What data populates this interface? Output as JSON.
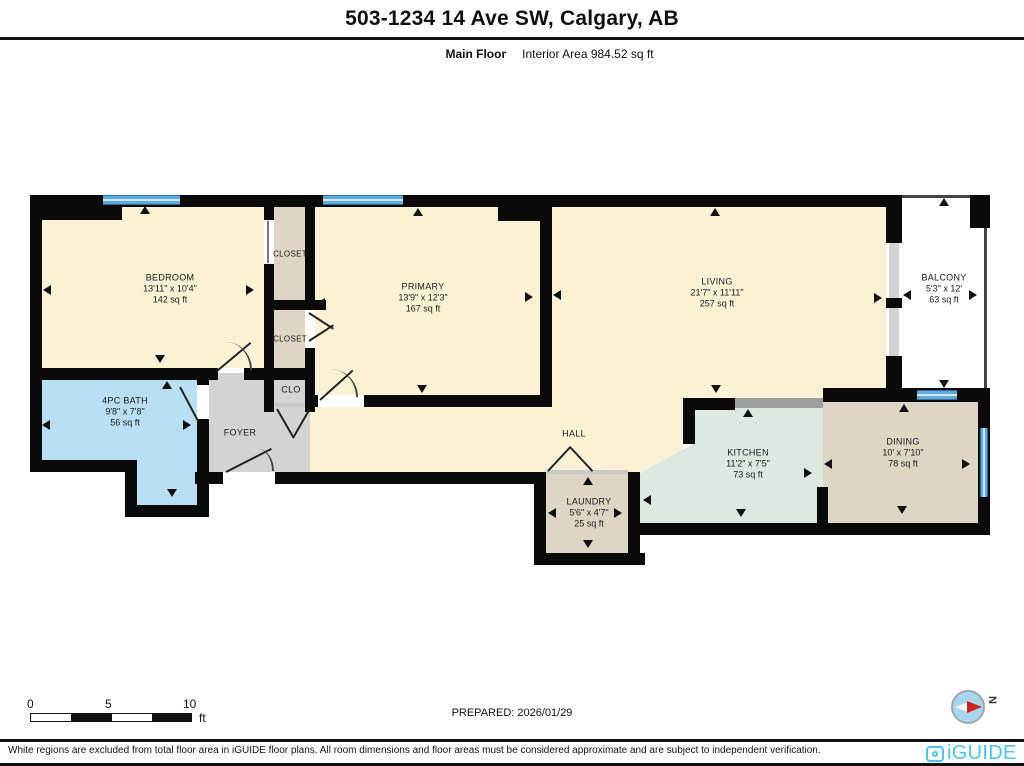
{
  "header": {
    "title": "503-1234 14 Ave SW, Calgary, AB",
    "floor_label": "Main Floor",
    "interior_area": "Interior Area 984.52 sq ft"
  },
  "rooms": {
    "bedroom": {
      "name": "BEDROOM",
      "dims": "13'11\" x 10'4\"",
      "area": "142 sq ft"
    },
    "closet_top": {
      "name": "CLOSET"
    },
    "closet_mid": {
      "name": "CLOSET"
    },
    "clo": {
      "name": "CLO"
    },
    "primary": {
      "name": "PRIMARY",
      "dims": "13'9\" x 12'3\"",
      "area": "167 sq ft"
    },
    "living": {
      "name": "LIVING",
      "dims": "21'7\" x 11'11\"",
      "area": "257 sq ft"
    },
    "balcony": {
      "name": "BALCONY",
      "dims": "5'3\" x 12'",
      "area": "63 sq ft"
    },
    "bath": {
      "name": "4PC BATH",
      "dims": "9'8\" x 7'8\"",
      "area": "56 sq ft"
    },
    "foyer": {
      "name": "FOYER"
    },
    "hall": {
      "name": "HALL"
    },
    "laundry": {
      "name": "LAUNDRY",
      "dims": "5'6\" x 4'7\"",
      "area": "25 sq ft"
    },
    "kitchen": {
      "name": "KITCHEN",
      "dims": "11'2\" x 7'5\"",
      "area": "73 sq ft"
    },
    "dining": {
      "name": "DINING",
      "dims": "10' x 7'10\"",
      "area": "78 sq ft"
    }
  },
  "footer": {
    "scale": {
      "t0": "0",
      "t5": "5",
      "t10": "10",
      "unit": "ft"
    },
    "prepared": "PREPARED: 2026/01/29",
    "compass_north": "N",
    "brand": "iGUIDE",
    "disclaimer": "White regions are excluded from total floor area in iGUIDE floor plans. All room dimensions and floor areas must be considered approximate and are subject to independent verification."
  },
  "colors": {
    "cream": "#FBF2D5",
    "tan": "#DDD6C4",
    "mint": "#DCE8E2",
    "bath": "#B9DFF4",
    "fgray": "#D3D3D3",
    "window_blue": "#5FA8D8",
    "counter_gray": "#9E9E9E",
    "wall_black": "#0A0A0A",
    "brand": "#4FC2E8",
    "compassblue": "#A9D6EE",
    "compassred": "#CC2418"
  }
}
